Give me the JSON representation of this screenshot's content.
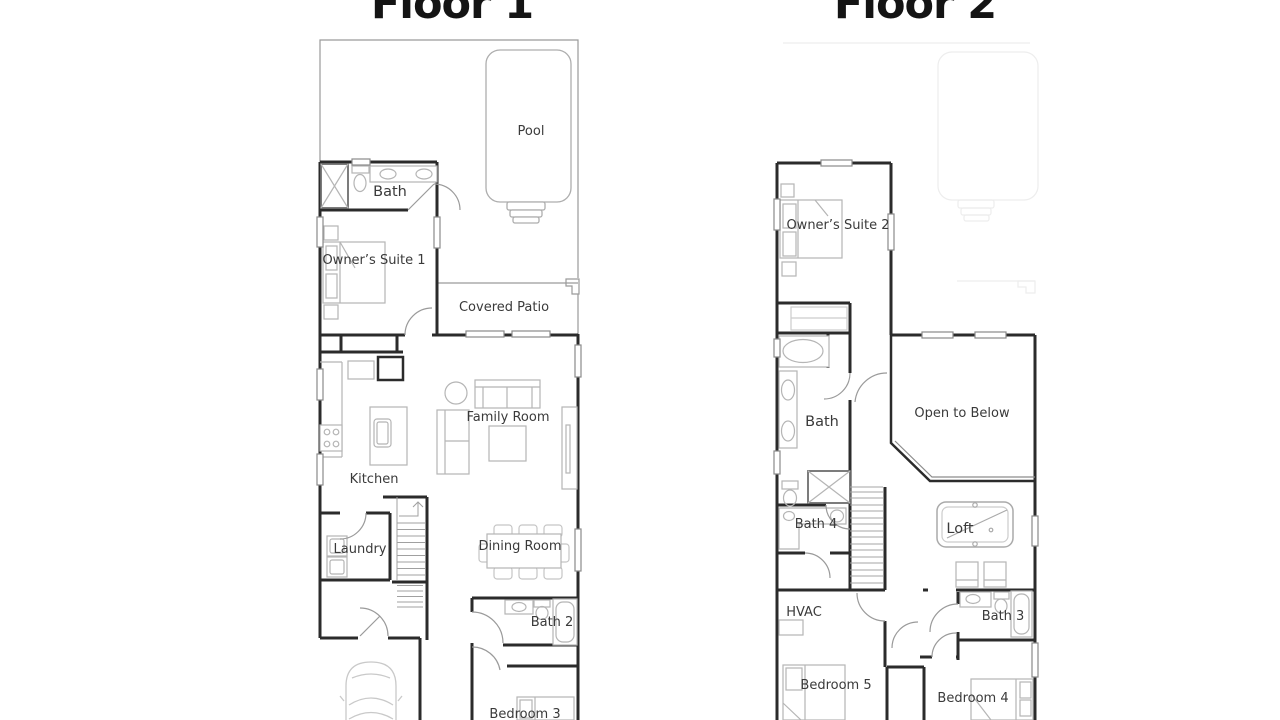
{
  "page": {
    "type": "floor-plan-sheet",
    "background": "#ffffff"
  },
  "colors": {
    "wall": "#2b2b2b",
    "fixture": "#b5b5b5",
    "door": "#9a9a9a",
    "site_line": "#9a9a9a",
    "ghost": "#ededed",
    "label": "#3a3a3a",
    "title": "#141414"
  },
  "floor1": {
    "title": "Floor 1",
    "labels": {
      "pool": "Pool",
      "bath": "Bath",
      "owners_suite_1": "Owner’s Suite 1",
      "covered_patio": "Covered Patio",
      "family_room": "Family Room",
      "kitchen": "Kitchen",
      "laundry": "Laundry",
      "dining_room": "Dining Room",
      "bath_2": "Bath 2",
      "bedroom_3": "Bedroom 3",
      "garage": "Garage"
    }
  },
  "floor2": {
    "title": "Floor 2",
    "labels": {
      "owners_suite_2": "Owner’s Suite 2",
      "bath": "Bath",
      "bath_4": "Bath 4",
      "hvac": "HVAC",
      "open_to_below": "Open to Below",
      "loft": "Loft",
      "bath_3": "Bath 3",
      "bedroom_5": "Bedroom 5",
      "bedroom_4": "Bedroom 4"
    }
  }
}
